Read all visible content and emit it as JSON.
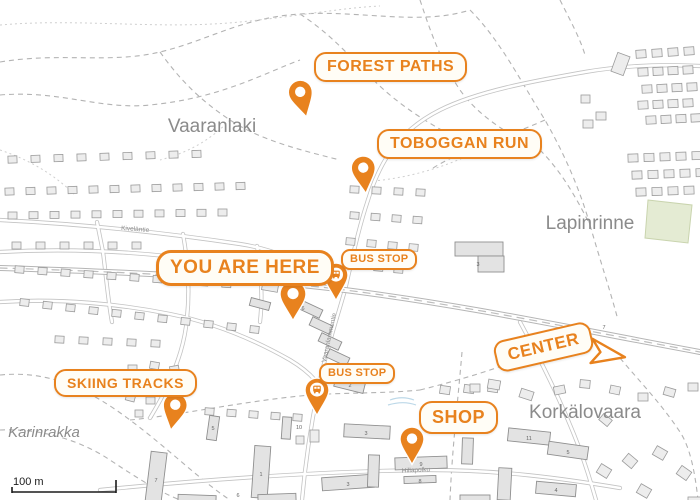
{
  "colors": {
    "accent_orange": "#E8821E",
    "place_name_gray": "#8B8B8B",
    "building_fill": "#EDEDED",
    "building_stroke": "#9B9B9B",
    "green_area_fill": "#E4EBD3",
    "water_blue": "#BCD8E8"
  },
  "annotations": {
    "forest_paths": "FOREST PATHS",
    "toboggan_run": "TOBOGGAN RUN",
    "you_are_here": "YOU ARE HERE",
    "bus_stop_1": "BUS STOP",
    "bus_stop_2": "BUS STOP",
    "shop": "SHOP",
    "skiing_tracks": "SKIING TRACKS",
    "center": "CENTER"
  },
  "map": {
    "place_names": [
      {
        "text": "Vaaranlaki",
        "x": 212,
        "y": 132,
        "size": 19,
        "italic": false
      },
      {
        "text": "Lapinrinne",
        "x": 590,
        "y": 229,
        "size": 19,
        "italic": false
      },
      {
        "text": "Karinrakka",
        "x": 44,
        "y": 437,
        "size": 15,
        "italic": true
      },
      {
        "text": "Korkälovaara",
        "x": 585,
        "y": 418,
        "size": 19,
        "italic": false
      }
    ],
    "street_names": [
      {
        "text": "Kiveläntie",
        "x": 135,
        "y": 231,
        "rotate": 4
      },
      {
        "text": "Vaaranlammentie",
        "x": 331,
        "y": 338,
        "rotate": -78
      },
      {
        "text": "Hillapolku",
        "x": 416,
        "y": 472,
        "rotate": -3
      }
    ],
    "building_numbers": [
      {
        "t": "3",
        "x": 478,
        "y": 266
      },
      {
        "t": "2",
        "x": 350,
        "y": 387
      },
      {
        "t": "5",
        "x": 213,
        "y": 430
      },
      {
        "t": "1",
        "x": 261,
        "y": 476
      },
      {
        "t": "7",
        "x": 156,
        "y": 482
      },
      {
        "t": "3",
        "x": 366,
        "y": 435
      },
      {
        "t": "3",
        "x": 348,
        "y": 486
      },
      {
        "t": "9",
        "x": 421,
        "y": 466
      },
      {
        "t": "8",
        "x": 420,
        "y": 483
      },
      {
        "t": "11",
        "x": 529,
        "y": 440
      },
      {
        "t": "6",
        "x": 238,
        "y": 497
      },
      {
        "t": "4",
        "x": 556,
        "y": 492
      },
      {
        "t": "5",
        "x": 568,
        "y": 454
      },
      {
        "t": "10",
        "x": 299,
        "y": 429
      },
      {
        "t": "6",
        "x": 303,
        "y": 310
      },
      {
        "t": "7",
        "x": 604,
        "y": 329
      }
    ],
    "scale_bar": {
      "label": "100 m"
    }
  }
}
